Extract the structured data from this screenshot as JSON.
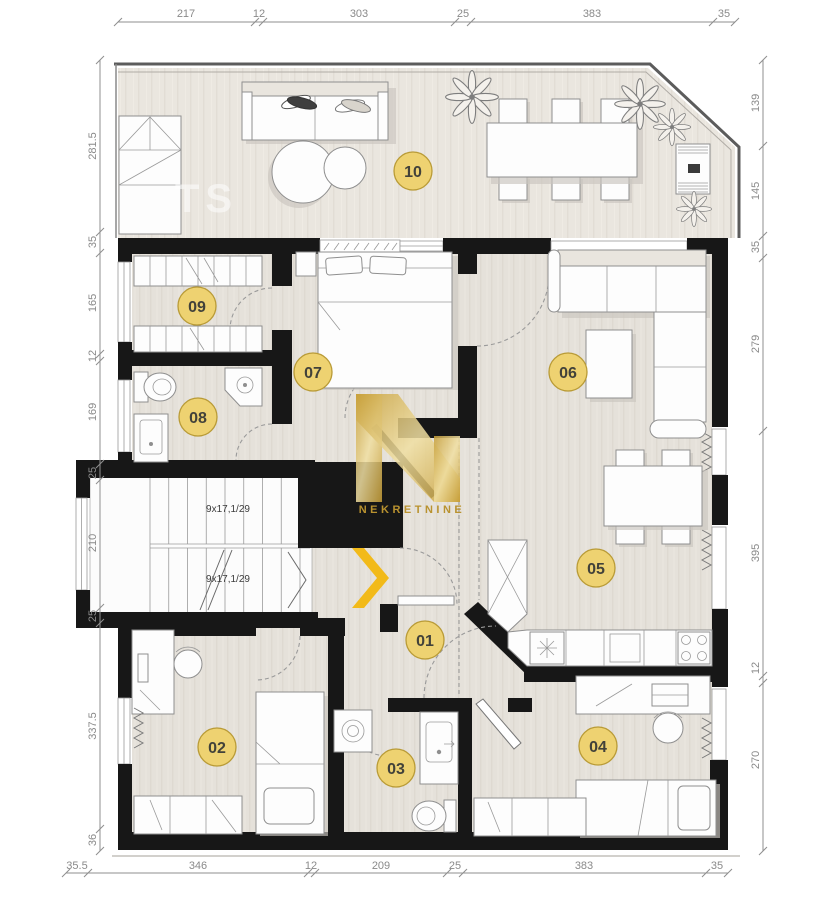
{
  "watermark": {
    "brand": "NEKRETNINE",
    "ghost": "TS"
  },
  "stairs": {
    "upper": "9x17,1/29",
    "lower": "9x17,1/29"
  },
  "rooms": [
    {
      "label": "01"
    },
    {
      "label": "02"
    },
    {
      "label": "03"
    },
    {
      "label": "04"
    },
    {
      "label": "05"
    },
    {
      "label": "06"
    },
    {
      "label": "07"
    },
    {
      "label": "08"
    },
    {
      "label": "09"
    },
    {
      "label": "10"
    }
  ],
  "dims": {
    "top": [
      "217",
      "12",
      "303",
      "25",
      "383",
      "35"
    ],
    "bottom": [
      "35.5",
      "346",
      "12",
      "209",
      "25",
      "383",
      "35"
    ],
    "left": [
      "281.5",
      "35",
      "165",
      "12",
      "169",
      "25",
      "210",
      "25",
      "337.5",
      "36"
    ],
    "right": [
      "139",
      "145",
      "35",
      "279",
      "395",
      "12",
      "270"
    ]
  },
  "colors": {
    "wall": "#171717",
    "floor": "#e5e1da",
    "terrace_floor": "#eae6df",
    "badge_fill": "#eed271",
    "badge_border": "#b99b37",
    "dim_text": "#8a8a8a",
    "watermark_gold": "#d9b44a",
    "chevron": "#f2ba19"
  }
}
